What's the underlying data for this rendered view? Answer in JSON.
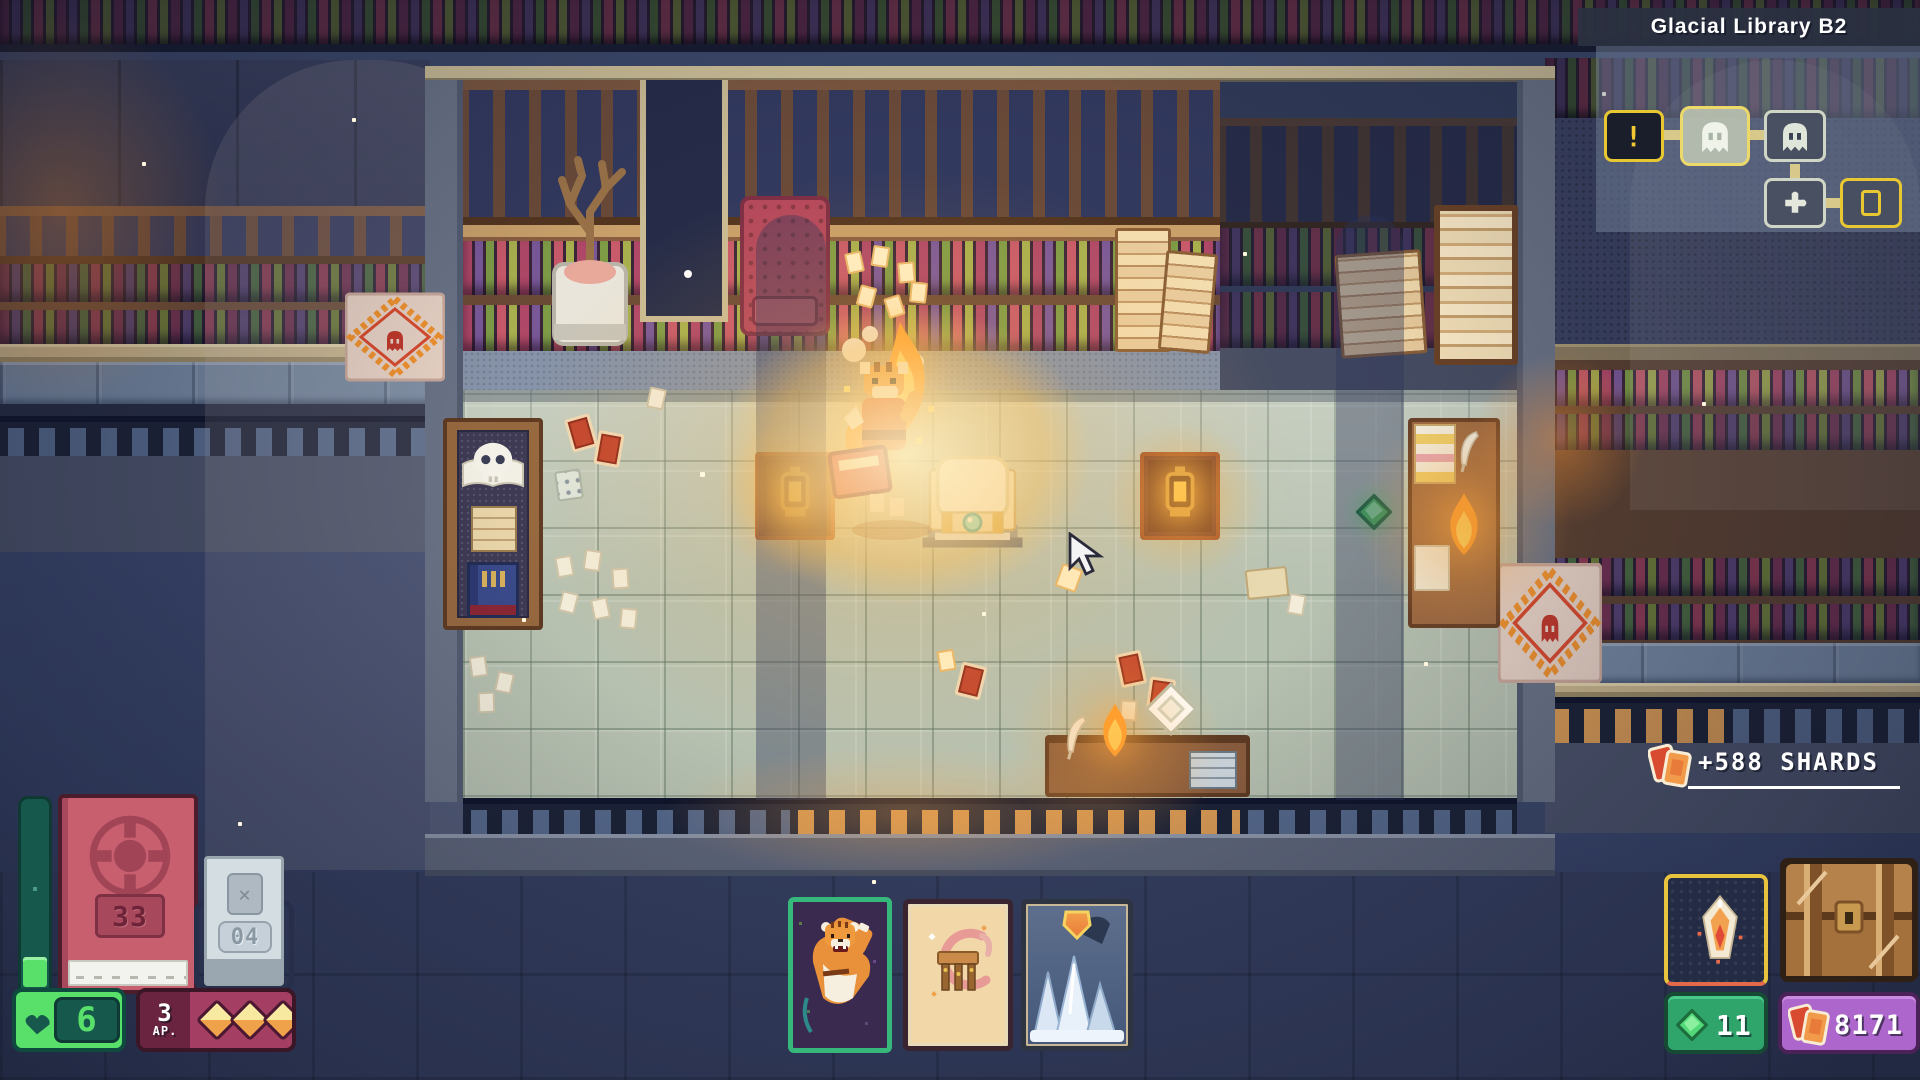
{
  "hud": {
    "minimap": {
      "title": "Glacial Library B2",
      "rooms": [
        {
          "id": "event-room",
          "icon": "!",
          "state": "alert"
        },
        {
          "id": "ghost-room-current",
          "state": "current"
        },
        {
          "id": "ghost-room",
          "state": "unexplored"
        },
        {
          "id": "puzzle-room",
          "state": "unexplored"
        },
        {
          "id": "edge-room",
          "state": "partial"
        }
      ]
    },
    "shard_popup": {
      "text": "+588 SHARDS"
    },
    "deck": {
      "count": "33"
    },
    "discard": {
      "count": "04"
    },
    "health": {
      "value": "6"
    },
    "action_points": {
      "value": "3",
      "label": "AP.",
      "pips": 3
    },
    "hand_cards": [
      {
        "name": "tiger-summon-card"
      },
      {
        "name": "wooden-table-card"
      },
      {
        "name": "ice-shield-card"
      }
    ],
    "resources": {
      "gems": "11",
      "shards": "8171"
    }
  },
  "icons": {
    "discard_x": "✕"
  },
  "scene": {
    "location_label": "Glacial Library B2"
  },
  "colors": {
    "accent_yellow": "#e8c832",
    "hp_green": "#58e06a",
    "ap_magenta": "#a43f63",
    "gem_green": "#2fa56b",
    "shard_purple": "#ad66cc",
    "warm_glow": "#ffb347"
  }
}
